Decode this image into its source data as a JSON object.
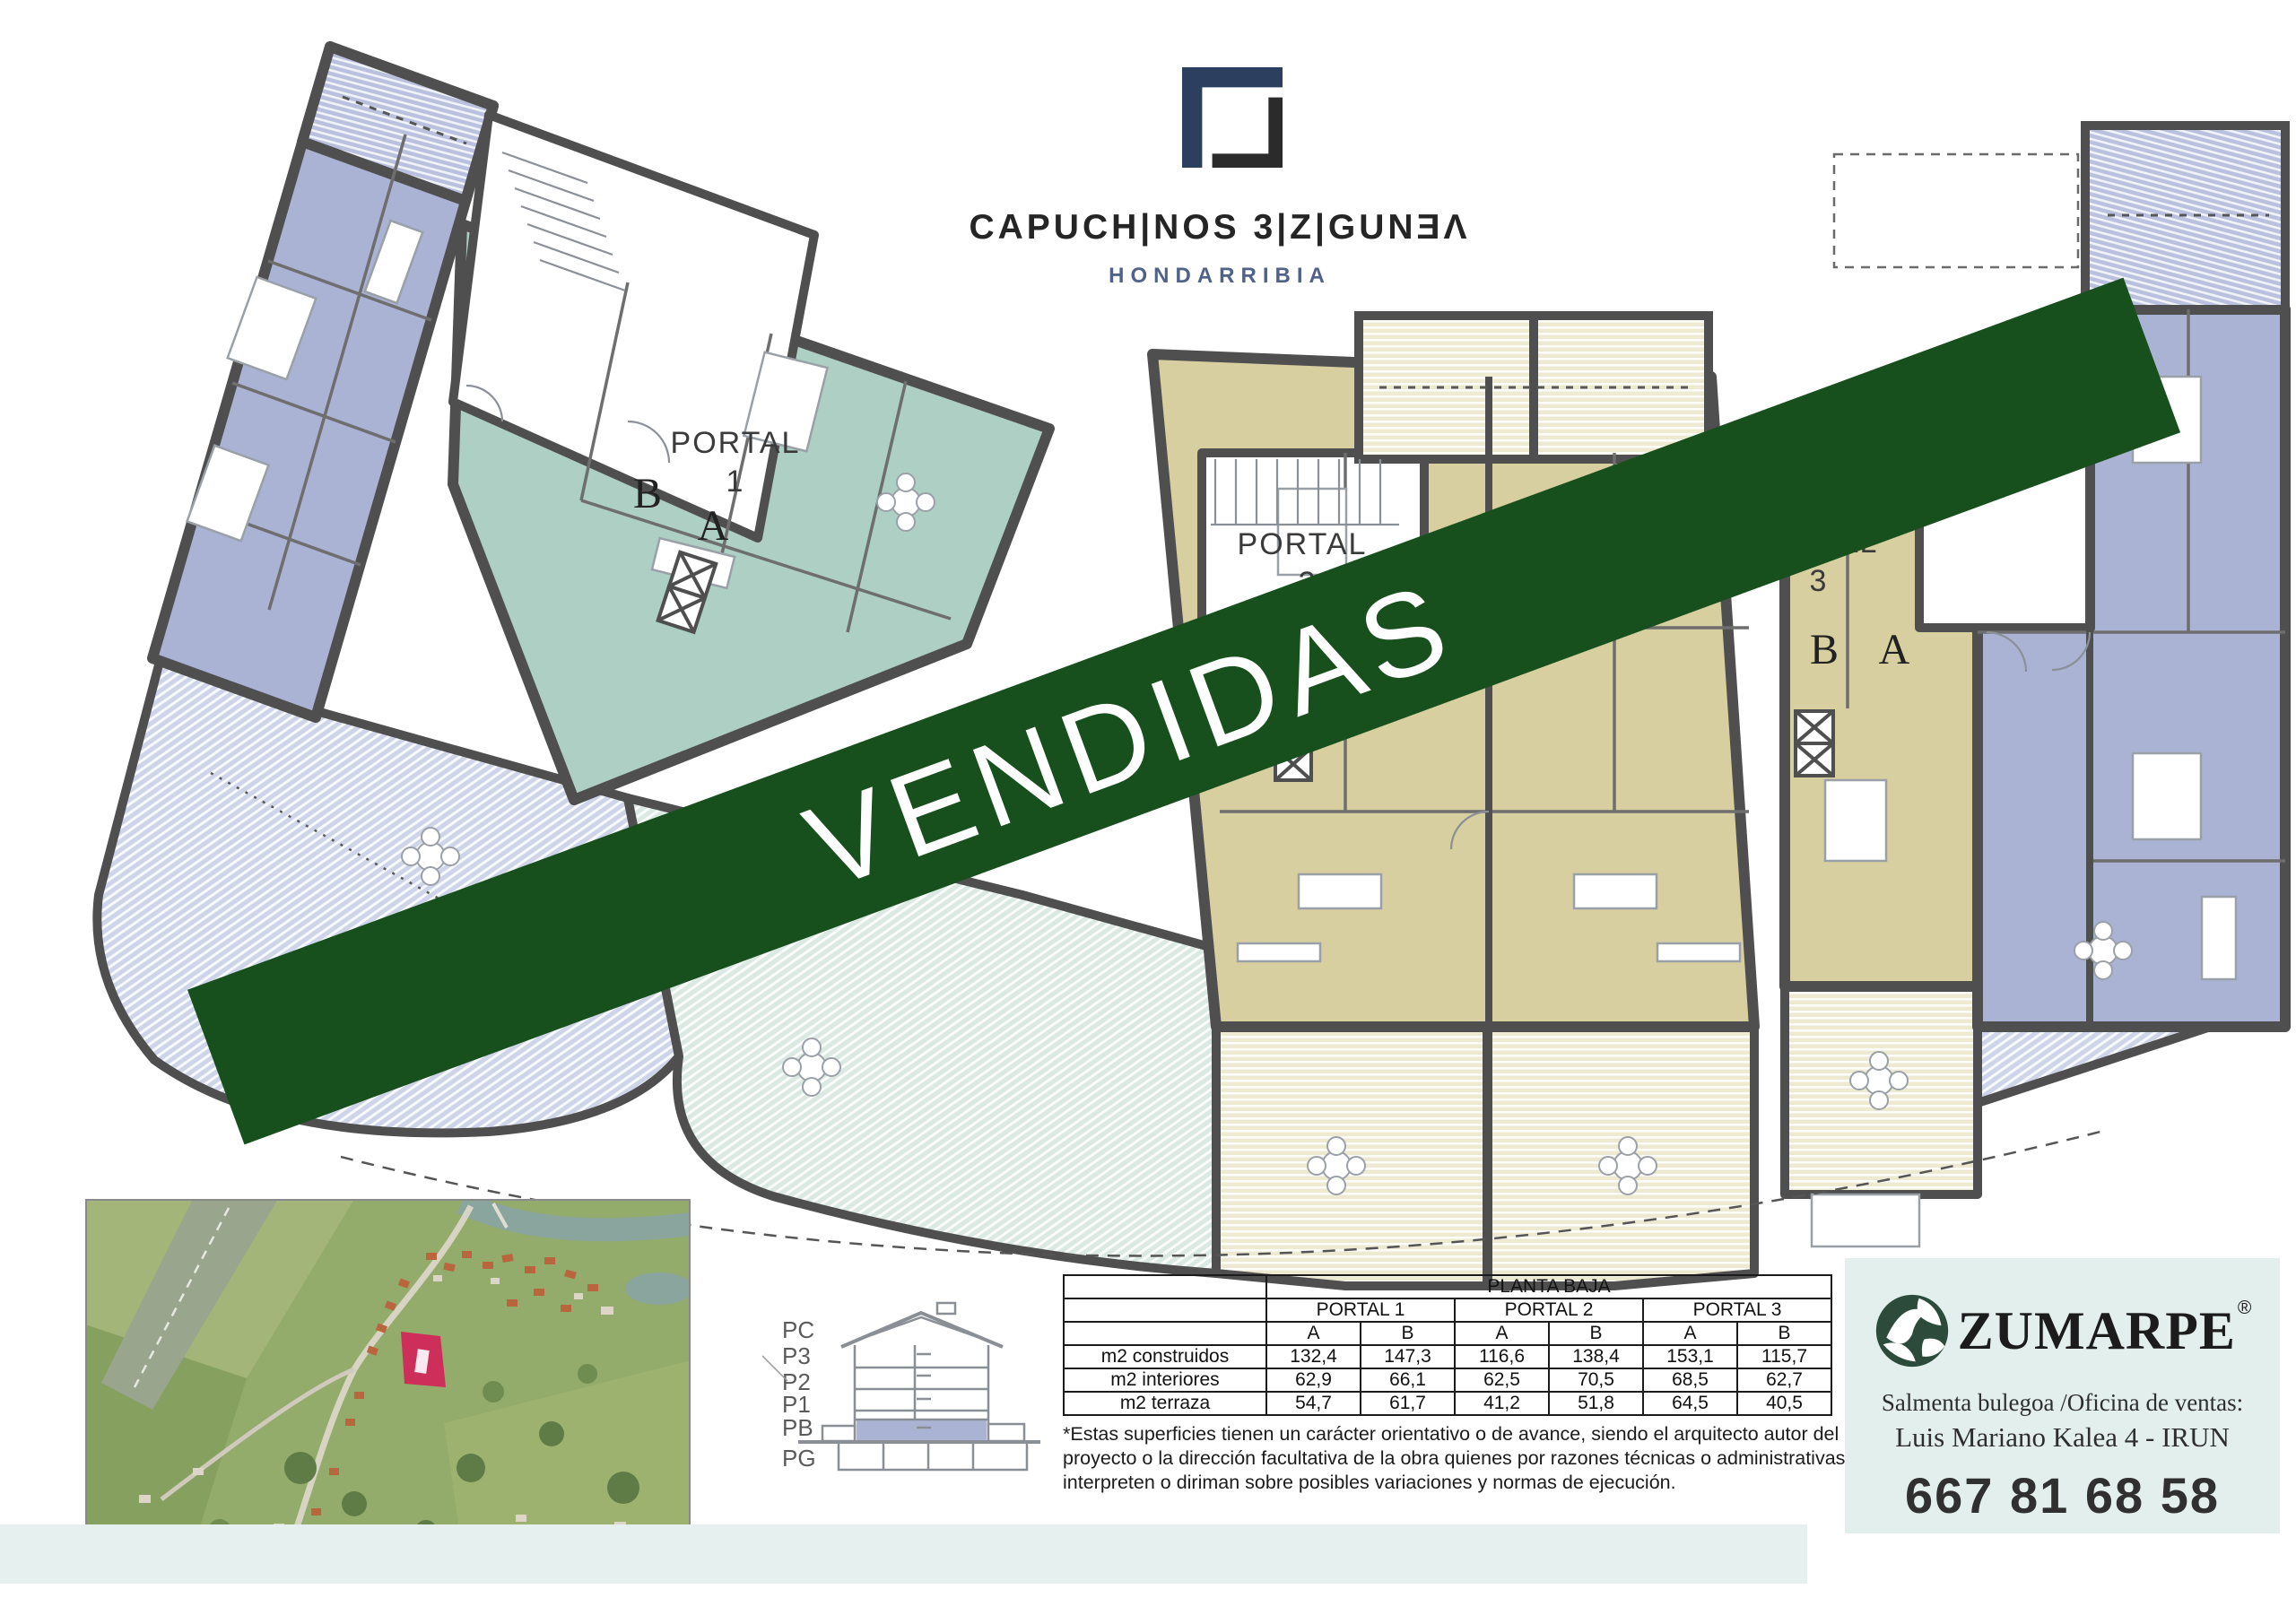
{
  "brand": {
    "title": "CAPUCH|NOS 3|Z|GUNƎΛ",
    "subtitle": "HONDARRIBIA"
  },
  "plan": {
    "sold_banner": "VENDIDAS",
    "portal1": {
      "label": "PORTAL",
      "number": "1",
      "unit_b": "B",
      "unit_a": "A"
    },
    "portal2": {
      "label": "PORTAL",
      "number": "2"
    },
    "portal3": {
      "label": "PORTAL",
      "number": "3",
      "unit_b": "B",
      "unit_a": "A"
    }
  },
  "section": {
    "floors": [
      "PC",
      "P3",
      "P2",
      "P1",
      "PB",
      "PG"
    ],
    "highlighted_floor": "PB"
  },
  "surface_table": {
    "title": "PLANTA BAJA",
    "portals": [
      "PORTAL 1",
      "PORTAL 2",
      "PORTAL 3"
    ],
    "unit_headers": [
      "A",
      "B",
      "A",
      "B",
      "A",
      "B"
    ],
    "rows": [
      {
        "label": "m2 construidos",
        "values": [
          "132,4",
          "147,3",
          "116,6",
          "138,4",
          "153,1",
          "115,7"
        ]
      },
      {
        "label": "m2 interiores",
        "values": [
          "62,9",
          "66,1",
          "62,5",
          "70,5",
          "68,5",
          "62,7"
        ]
      },
      {
        "label": "m2 terraza",
        "values": [
          "54,7",
          "61,7",
          "41,2",
          "51,8",
          "64,5",
          "40,5"
        ]
      }
    ]
  },
  "footnote": "*Estas superficies tienen un carácter orientativo o de avance, siendo el arquitecto autor del proyecto o la dirección facultativa de la obra quienes por razones técnicas o administrativas interpreten o diriman sobre posibles variaciones y normas de ejecución.",
  "vendor": {
    "name": "ZUMARPE",
    "registered": "®",
    "office_line": "Salmenta bulegoa /Oficina de ventas:",
    "address_line": "Luis Mariano Kalea 4 - IRUN",
    "phone": "667 81 68 58"
  },
  "colors": {
    "banner_green": "#17501d",
    "wall_gray": "#4f4f4f",
    "apartment_lavender": "#aab3d4",
    "apartment_teal": "#aecfc3",
    "apartment_tan": "#d7cf9f",
    "vendor_green": "#2c4b3b",
    "site_marker_red": "#ce2f5a",
    "vendor_panel": "#e3efec"
  }
}
